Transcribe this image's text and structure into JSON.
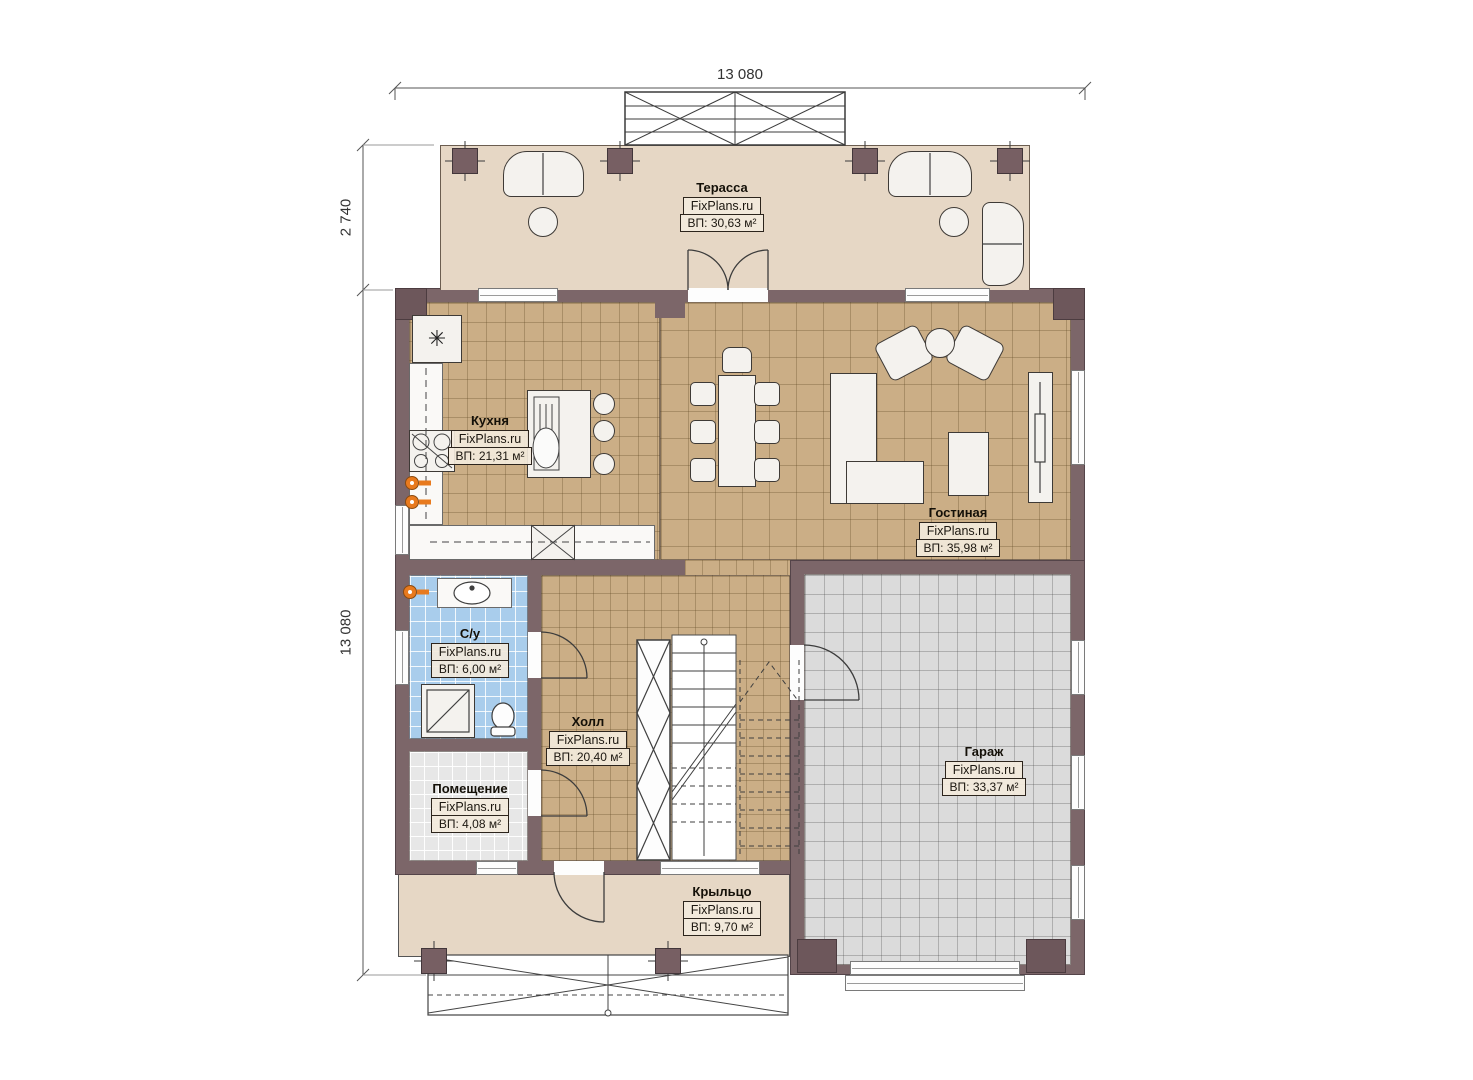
{
  "dimensions": {
    "top": "13 080",
    "side_upper": "2 740",
    "side_lower": "13 080"
  },
  "rooms": {
    "terrace": {
      "name": "Терасса",
      "brand": "FixPlans.ru",
      "area": "ВП: 30,63 м²"
    },
    "kitchen": {
      "name": "Кухня",
      "brand": "FixPlans.ru",
      "area": "ВП: 21,31 м²"
    },
    "living": {
      "name": "Гостиная",
      "brand": "FixPlans.ru",
      "area": "ВП: 35,98 м²"
    },
    "bathroom": {
      "name": "С/у",
      "brand": "FixPlans.ru",
      "area": "ВП: 6,00 м²"
    },
    "hall": {
      "name": "Холл",
      "brand": "FixPlans.ru",
      "area": "ВП: 20,40 м²"
    },
    "utility": {
      "name": "Помещение",
      "brand": "FixPlans.ru",
      "area": "ВП: 4,08 м²"
    },
    "garage": {
      "name": "Гараж",
      "brand": "FixPlans.ru",
      "area": "ВП: 33,37 м²"
    },
    "porch": {
      "name": "Крыльцо",
      "brand": "FixPlans.ru",
      "area": "ВП: 9,70 м²"
    }
  },
  "icons": {
    "fridge_snowflake": "✳"
  },
  "colors": {
    "wall": "#7c6669",
    "terrace_floor": "#e6d7c5",
    "tile_tan": "#cbae86",
    "tile_blue": "#a9cdec",
    "tile_gray": "#dbdbdb",
    "tile_light": "#e7e7e7",
    "accent_orange": "#e87a1e"
  }
}
